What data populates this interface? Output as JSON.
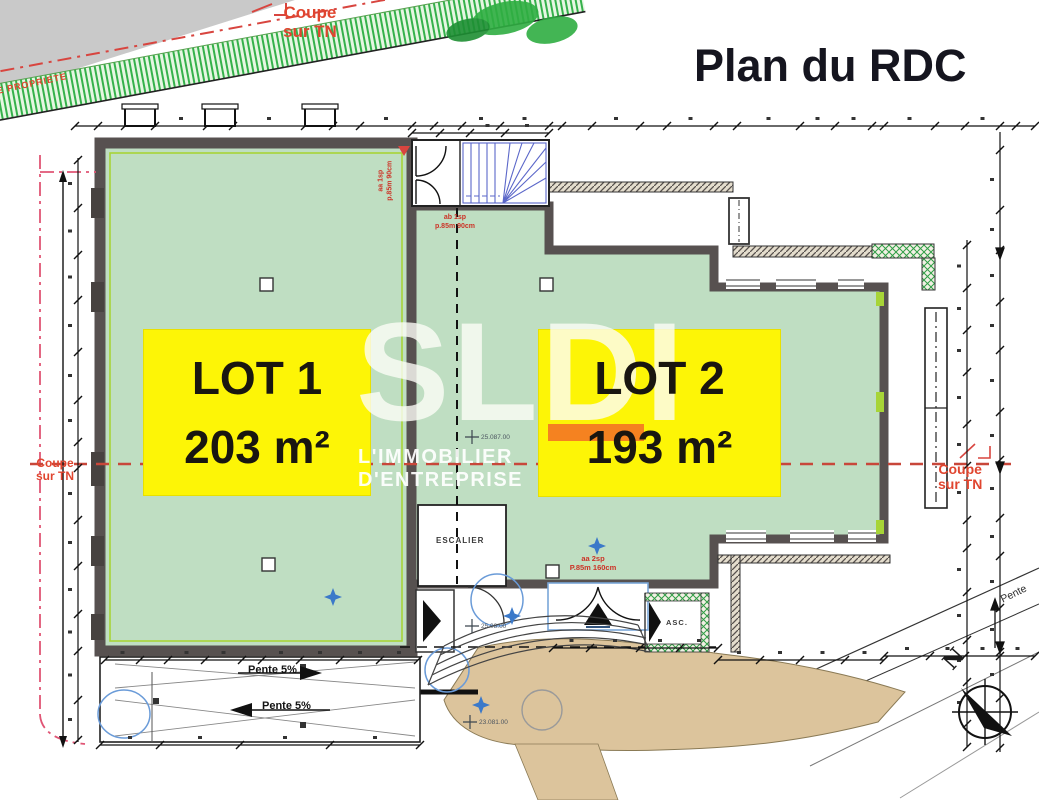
{
  "title": "Plan du RDC",
  "watermark": {
    "logo": "SLDI",
    "tagline": "L'IMMOBILIER D'ENTREPRISE"
  },
  "lots": [
    {
      "name": "LOT 1",
      "area": "203 m²"
    },
    {
      "name": "LOT 2",
      "area": "193 m²"
    }
  ],
  "coupe_top": {
    "line1": "Coupe",
    "line2": "sur TN"
  },
  "coupe_left": {
    "line1": "Coupe",
    "line2": "sur TN"
  },
  "coupe_right": {
    "line1": "Coupe",
    "line2": "sur TN"
  },
  "labels": {
    "escalier": "ESCALIER",
    "asc": "ASC.",
    "north": "N",
    "pente_up": "Pente 5%",
    "pente_down": "Pente 5%",
    "pente_right": "Pente",
    "propriete": "E PROPRIETE"
  },
  "annotations": {
    "lot1_window_l1": "aa 1sp",
    "lot1_window_l2": "p.85m 90cm",
    "lot2_window_l1": "ab 1sp",
    "lot2_window_l2": "p.85m 90cm",
    "lot2_bay_l1": "aa 2sp",
    "lot2_bay_l2": "P.85m 160cm",
    "elev_center": "25.087.00",
    "elev_entrance": "25.08.00",
    "elev_terrain": "23.081.00"
  },
  "colors": {
    "room_green": "#bfdec2",
    "wall_dark": "#575150",
    "label_yellow": "#fdf506",
    "logo_orange": "#f58220",
    "section_red": "#c8473a",
    "property_pink": "#e05575",
    "stair_blue": "#5b67c9",
    "terrain_tan": "#dcc49c",
    "accent_lime": "#a7d437"
  }
}
